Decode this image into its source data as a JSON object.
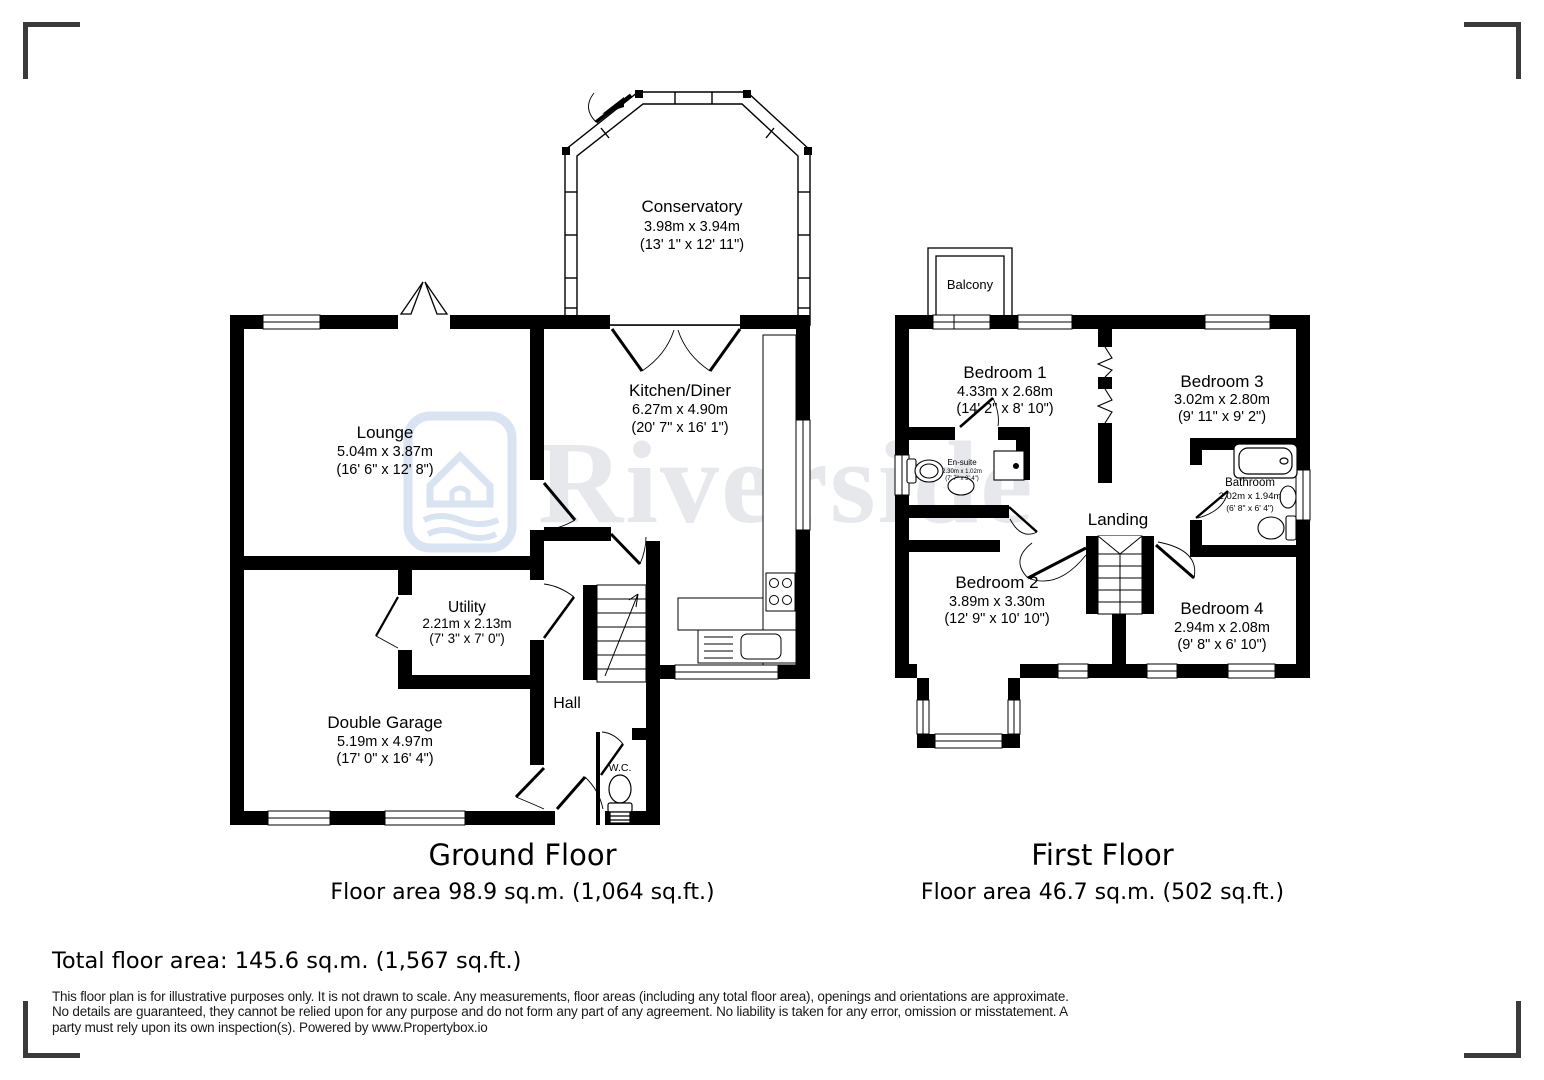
{
  "watermark": {
    "brand": "Riverside",
    "icon": "house-river-logo",
    "text_color": "#e6e8eb",
    "icon_color": "#d9e3f1"
  },
  "ground_floor": {
    "title": "Ground Floor",
    "floor_area": "Floor area 98.9 sq.m. (1,064 sq.ft.)",
    "rooms": {
      "conservatory": {
        "name": "Conservatory",
        "metric": "3.98m x 3.94m",
        "imperial": "(13' 1\" x 12' 11\")"
      },
      "lounge": {
        "name": "Lounge",
        "metric": "5.04m x 3.87m",
        "imperial": "(16' 6\" x 12' 8\")"
      },
      "kitchen_diner": {
        "name": "Kitchen/Diner",
        "metric": "6.27m x 4.90m",
        "imperial": "(20' 7\" x 16' 1\")"
      },
      "utility": {
        "name": "Utility",
        "metric": "2.21m x 2.13m",
        "imperial": "(7' 3\" x 7' 0\")"
      },
      "double_garage": {
        "name": "Double Garage",
        "metric": "5.19m x 4.97m",
        "imperial": "(17' 0\" x 16' 4\")"
      },
      "hall": {
        "name": "Hall"
      },
      "wc": {
        "name": "W.C."
      }
    }
  },
  "first_floor": {
    "title": "First Floor",
    "floor_area": "Floor area 46.7 sq.m. (502 sq.ft.)",
    "rooms": {
      "balcony": {
        "name": "Balcony"
      },
      "bedroom_1": {
        "name": "Bedroom 1",
        "metric": "4.33m x 2.68m",
        "imperial": "(14' 2\" x 8' 10\")"
      },
      "bedroom_3": {
        "name": "Bedroom 3",
        "metric": "3.02m x 2.80m",
        "imperial": "(9' 11\" x 9' 2\")"
      },
      "en_suite": {
        "name": "En-suite",
        "metric": "2.30m x 1.02m",
        "imperial": "(7' 7\" x 3' 4\")"
      },
      "bathroom": {
        "name": "Bathroom",
        "metric": "2.02m x 1.94m",
        "imperial": "(6' 8\" x 6' 4\")"
      },
      "landing": {
        "name": "Landing"
      },
      "bedroom_2": {
        "name": "Bedroom 2",
        "metric": "3.89m x 3.30m",
        "imperial": "(12' 9\" x 10' 10\")"
      },
      "bedroom_4": {
        "name": "Bedroom 4",
        "metric": "2.94m x 2.08m",
        "imperial": "(9' 8\" x 6' 10\")"
      }
    }
  },
  "summary": {
    "total_floor_area": "Total floor area: 145.6 sq.m. (1,567 sq.ft.)"
  },
  "disclaimer": "This floor plan is for illustrative purposes only. It is not drawn to scale. Any measurements, floor areas (including any total floor area), openings and orientations are approximate. No details are guaranteed, they cannot be relied upon for any purpose and do not form any part of any agreement. No liability is taken for any error, omission or misstatement. A party must rely upon its own inspection(s). Powered by www.Propertybox.io"
}
